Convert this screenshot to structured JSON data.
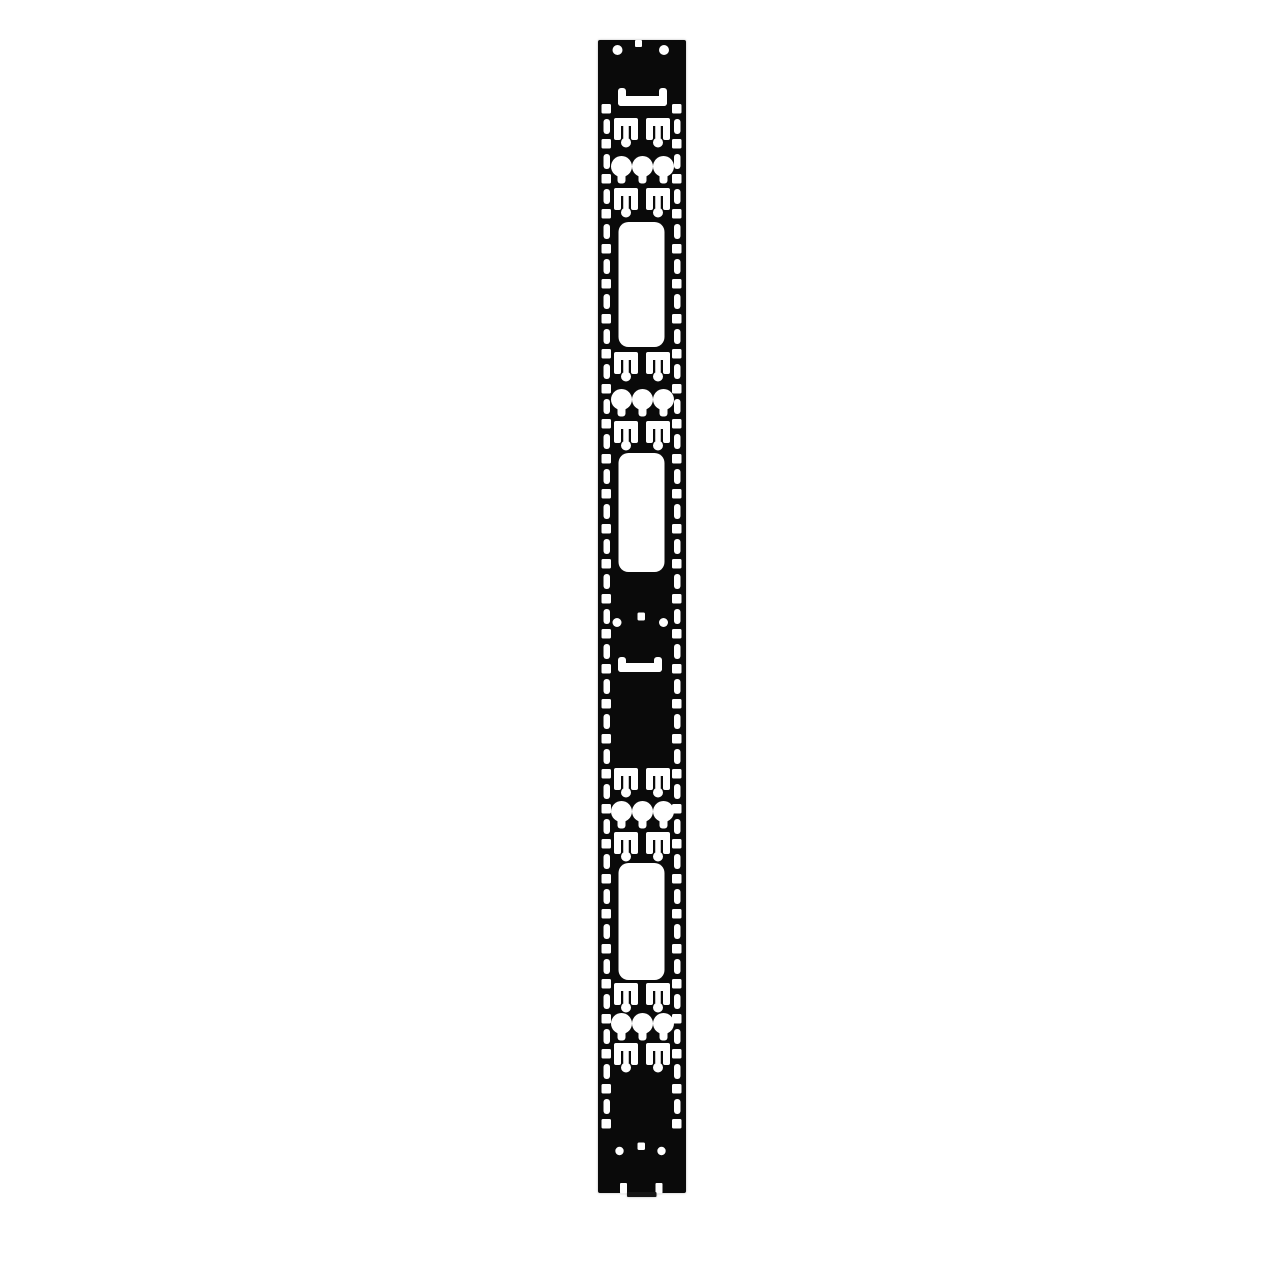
{
  "image": {
    "width": 1280,
    "height": 1280,
    "background_color": "#ffffff"
  },
  "part": {
    "kind": "vertical-rack-cable-management-rail",
    "color": "#0a0a0a",
    "cutout_color": "#ffffff",
    "x": 598,
    "y": 40,
    "width": 88,
    "height": 1153,
    "corner_radius": 2
  },
  "features": {
    "top_edge_notch": {
      "x": 635,
      "y": 40,
      "w": 7,
      "h": 7,
      "r": 1
    },
    "top_holes": [
      {
        "cx": 617.5,
        "cy": 50,
        "r": 5
      },
      {
        "cx": 664.0,
        "cy": 50,
        "r": 5
      }
    ],
    "handle_slots": [
      {
        "x": 618,
        "y": 88,
        "w": 49,
        "h": 18,
        "leg_w": 8,
        "bar_h": 10,
        "r": 3
      },
      {
        "x": 618,
        "y": 657,
        "w": 44,
        "h": 15,
        "leg_w": 8,
        "bar_h": 9,
        "r": 3
      }
    ],
    "edge_ladder": {
      "square": {
        "size": 9.5,
        "r": 1.5,
        "left_x": 601.5,
        "right_x": 672.0,
        "start_y": 104,
        "period": 35,
        "count": 30
      },
      "slot": {
        "w": 6.5,
        "h": 15,
        "r": 3,
        "left_x": 603.5,
        "right_x": 674.0,
        "start_y": 119,
        "period": 35,
        "count": 29
      }
    },
    "t_slot_pairs": {
      "unit_w": 24,
      "bar_h": 8,
      "leg_w": 7,
      "leg_h": 17,
      "stem_w": 5.5,
      "stem_h": 16,
      "blob_r": 5,
      "blob_cy": 24.5,
      "left_x": 614,
      "right_x": 646,
      "y_positions": [
        118,
        188,
        352,
        421,
        768,
        832,
        983,
        1043
      ]
    },
    "keyhole_trios": {
      "circle_r": 10.5,
      "slot_w": 8,
      "slot_depth": 17,
      "slot_r": 3,
      "center_xs": [
        621.5,
        642.5,
        663.5
      ],
      "y_positions": [
        156,
        389,
        801,
        1013
      ]
    },
    "large_slots": [
      {
        "x": 618.5,
        "y": 222,
        "w": 46,
        "h": 125,
        "r": 10
      },
      {
        "x": 618.5,
        "y": 453,
        "w": 46,
        "h": 119,
        "r": 10
      },
      {
        "x": 618.5,
        "y": 863,
        "w": 46,
        "h": 117,
        "r": 10
      }
    ],
    "mid_holes": {
      "square": {
        "x": 637.5,
        "y": 612.5,
        "w": 7.5,
        "h": 8,
        "r": 1.5
      },
      "circles": [
        {
          "cx": 617.0,
          "cy": 622.5,
          "r": 4.5
        },
        {
          "cx": 663.5,
          "cy": 622.5,
          "r": 4.5
        }
      ]
    },
    "bottom_holes": {
      "square": {
        "x": 637.5,
        "y": 1142.5,
        "w": 7.5,
        "h": 7.5,
        "r": 1.5
      },
      "circles": [
        {
          "cx": 619.5,
          "cy": 1151,
          "r": 4.2
        },
        {
          "cx": 661.5,
          "cy": 1151,
          "r": 4.2
        }
      ]
    },
    "bottom_notches": [
      {
        "x": 620.0,
        "y": 1183,
        "w": 7,
        "h": 10.5,
        "r": 1
      },
      {
        "x": 655.5,
        "y": 1183,
        "w": 7,
        "h": 10.5,
        "r": 1
      }
    ],
    "bottom_tab": {
      "x": 627,
      "y": 1192,
      "w": 29.5,
      "h": 5,
      "color": "#161616"
    }
  }
}
